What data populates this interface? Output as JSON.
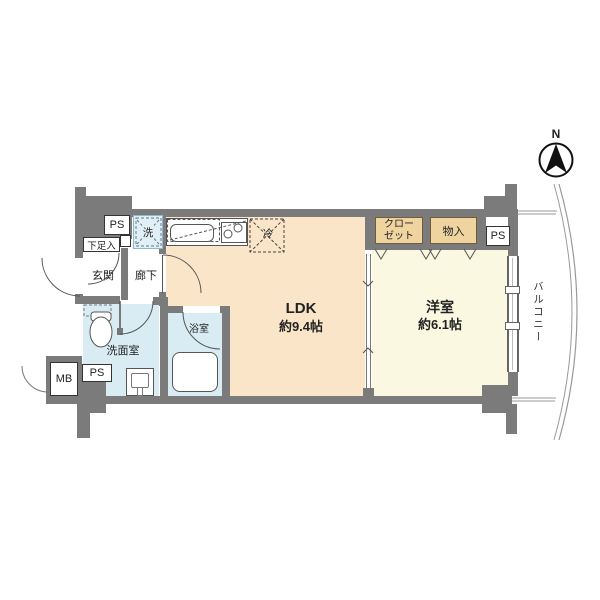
{
  "compass": {
    "north_label": "N"
  },
  "rooms": {
    "ldk": {
      "name": "LDK",
      "size": "約9.4帖"
    },
    "western_room": {
      "name": "洋室",
      "size": "約6.1帖"
    },
    "entrance": "玄関",
    "hallway": "廊下",
    "washroom": "洗面室",
    "bathroom": "浴室",
    "balcony": "バルコニー"
  },
  "storage": {
    "closet": "クローゼット",
    "storage_cabinet": "物入",
    "shoe_cabinet": "下足入"
  },
  "equipment": {
    "washing_machine": "洗",
    "refrigerator": "冷"
  },
  "service": {
    "pipe_space_top_left": "PS",
    "pipe_space_top_right": "PS",
    "pipe_space_bottom_left": "PS",
    "meter_box": "MB"
  },
  "colors": {
    "ldk_floor": "#fae5c9",
    "western_floor": "#fbf8e2",
    "closet_fill": "#efd4a0",
    "wet_area_floor": "#d9ecf3",
    "wall": "#7b7b7b",
    "line": "#555555"
  }
}
